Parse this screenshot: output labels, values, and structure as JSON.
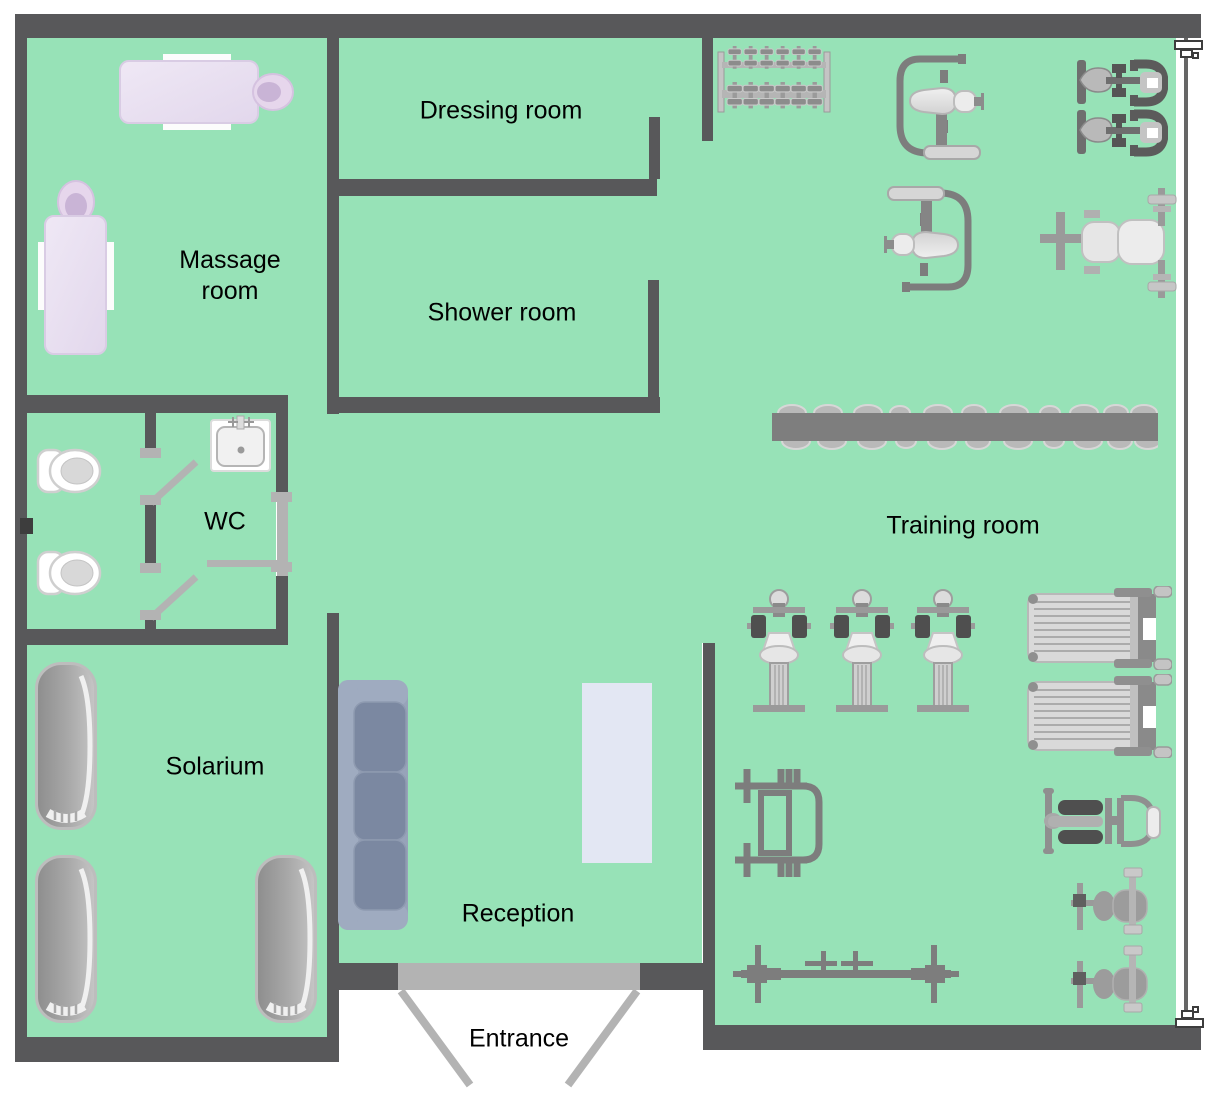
{
  "diagram": {
    "type": "floor-plan",
    "facility": "Gym and Spa Area Plan",
    "rooms": [
      {
        "name": "Massage room",
        "label_center": {
          "x": 230,
          "y": 276
        }
      },
      {
        "name": "Dressing room",
        "label_center": {
          "x": 501,
          "y": 111
        }
      },
      {
        "name": "Shower room",
        "label_center": {
          "x": 502,
          "y": 313
        }
      },
      {
        "name": "WC",
        "label_center": {
          "x": 225,
          "y": 522
        }
      },
      {
        "name": "Solarium",
        "label_center": {
          "x": 215,
          "y": 767
        }
      },
      {
        "name": "Reception",
        "label_center": {
          "x": 518,
          "y": 914
        }
      },
      {
        "name": "Entrance",
        "label_center": {
          "x": 519,
          "y": 1039
        }
      },
      {
        "name": "Training room",
        "label_center": {
          "x": 963,
          "y": 526
        }
      }
    ],
    "equipment": [
      {
        "item": "massage-table",
        "room": "Massage room",
        "count": 2
      },
      {
        "item": "toilet",
        "room": "WC",
        "count": 2
      },
      {
        "item": "sink",
        "room": "WC",
        "count": 1
      },
      {
        "item": "interior-door",
        "room": "WC",
        "count": 3
      },
      {
        "item": "tanning-bed",
        "room": "Solarium",
        "count": 3
      },
      {
        "item": "sofa",
        "room": "Reception",
        "count": 1
      },
      {
        "item": "reception-desk",
        "room": "Reception",
        "count": 1
      },
      {
        "item": "entrance-double-door",
        "room": "Entrance",
        "count": 1
      },
      {
        "item": "dumbbell-rack",
        "room": "Training room",
        "count": 1
      },
      {
        "item": "shoulder-press-machine",
        "room": "Training room",
        "count": 2
      },
      {
        "item": "pec-deck-machine",
        "room": "Training room",
        "count": 2
      },
      {
        "item": "bench-with-barbell",
        "room": "Training room",
        "count": 1
      },
      {
        "item": "barbell-storage-rack",
        "room": "Training room",
        "count": 1
      },
      {
        "item": "exercise-bike",
        "room": "Training room",
        "count": 3
      },
      {
        "item": "treadmill",
        "room": "Training room",
        "count": 2
      },
      {
        "item": "squat-rack",
        "room": "Training room",
        "count": 1
      },
      {
        "item": "floor-barbell",
        "room": "Training room",
        "count": 1
      },
      {
        "item": "recumbent-bike",
        "room": "Training room",
        "count": 1
      },
      {
        "item": "hyperextension-bench",
        "room": "Training room",
        "count": 2
      },
      {
        "item": "wall-window-marker",
        "room": "Training room",
        "count": 2
      }
    ],
    "colors": {
      "floor": "#97e2b7",
      "wall": "#58585a",
      "door": "#b3b3b3",
      "equipment_gray": "#8c8c8c",
      "massage_table": "#e9e1f1",
      "sofa": "#7b88a1",
      "desk": "#e3e7f3",
      "background": "#ffffff"
    }
  }
}
